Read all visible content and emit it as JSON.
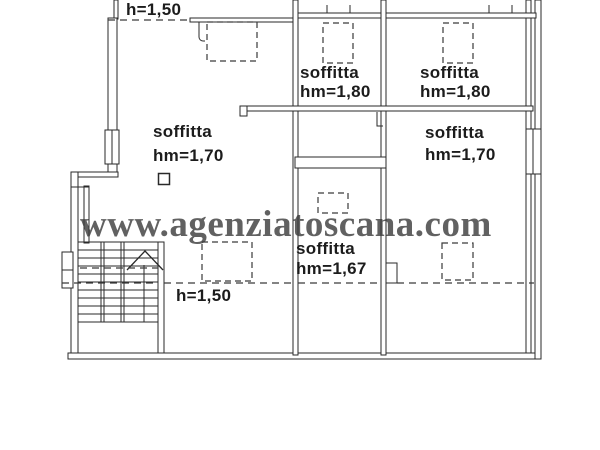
{
  "watermark": "www.agenziatoscana.com",
  "plan": {
    "heights": {
      "top": "h=1,50",
      "bottom": "h=1,50"
    },
    "rooms": [
      {
        "name": "soffitta",
        "height": "hm=1,80"
      },
      {
        "name": "soffitta",
        "height": "hm=1,80"
      },
      {
        "name": "soffitta",
        "height": "hm=1,70"
      },
      {
        "name": "soffitta",
        "height": "hm=1,70"
      },
      {
        "name": "soffitta",
        "height": "hm=1,67"
      }
    ]
  }
}
